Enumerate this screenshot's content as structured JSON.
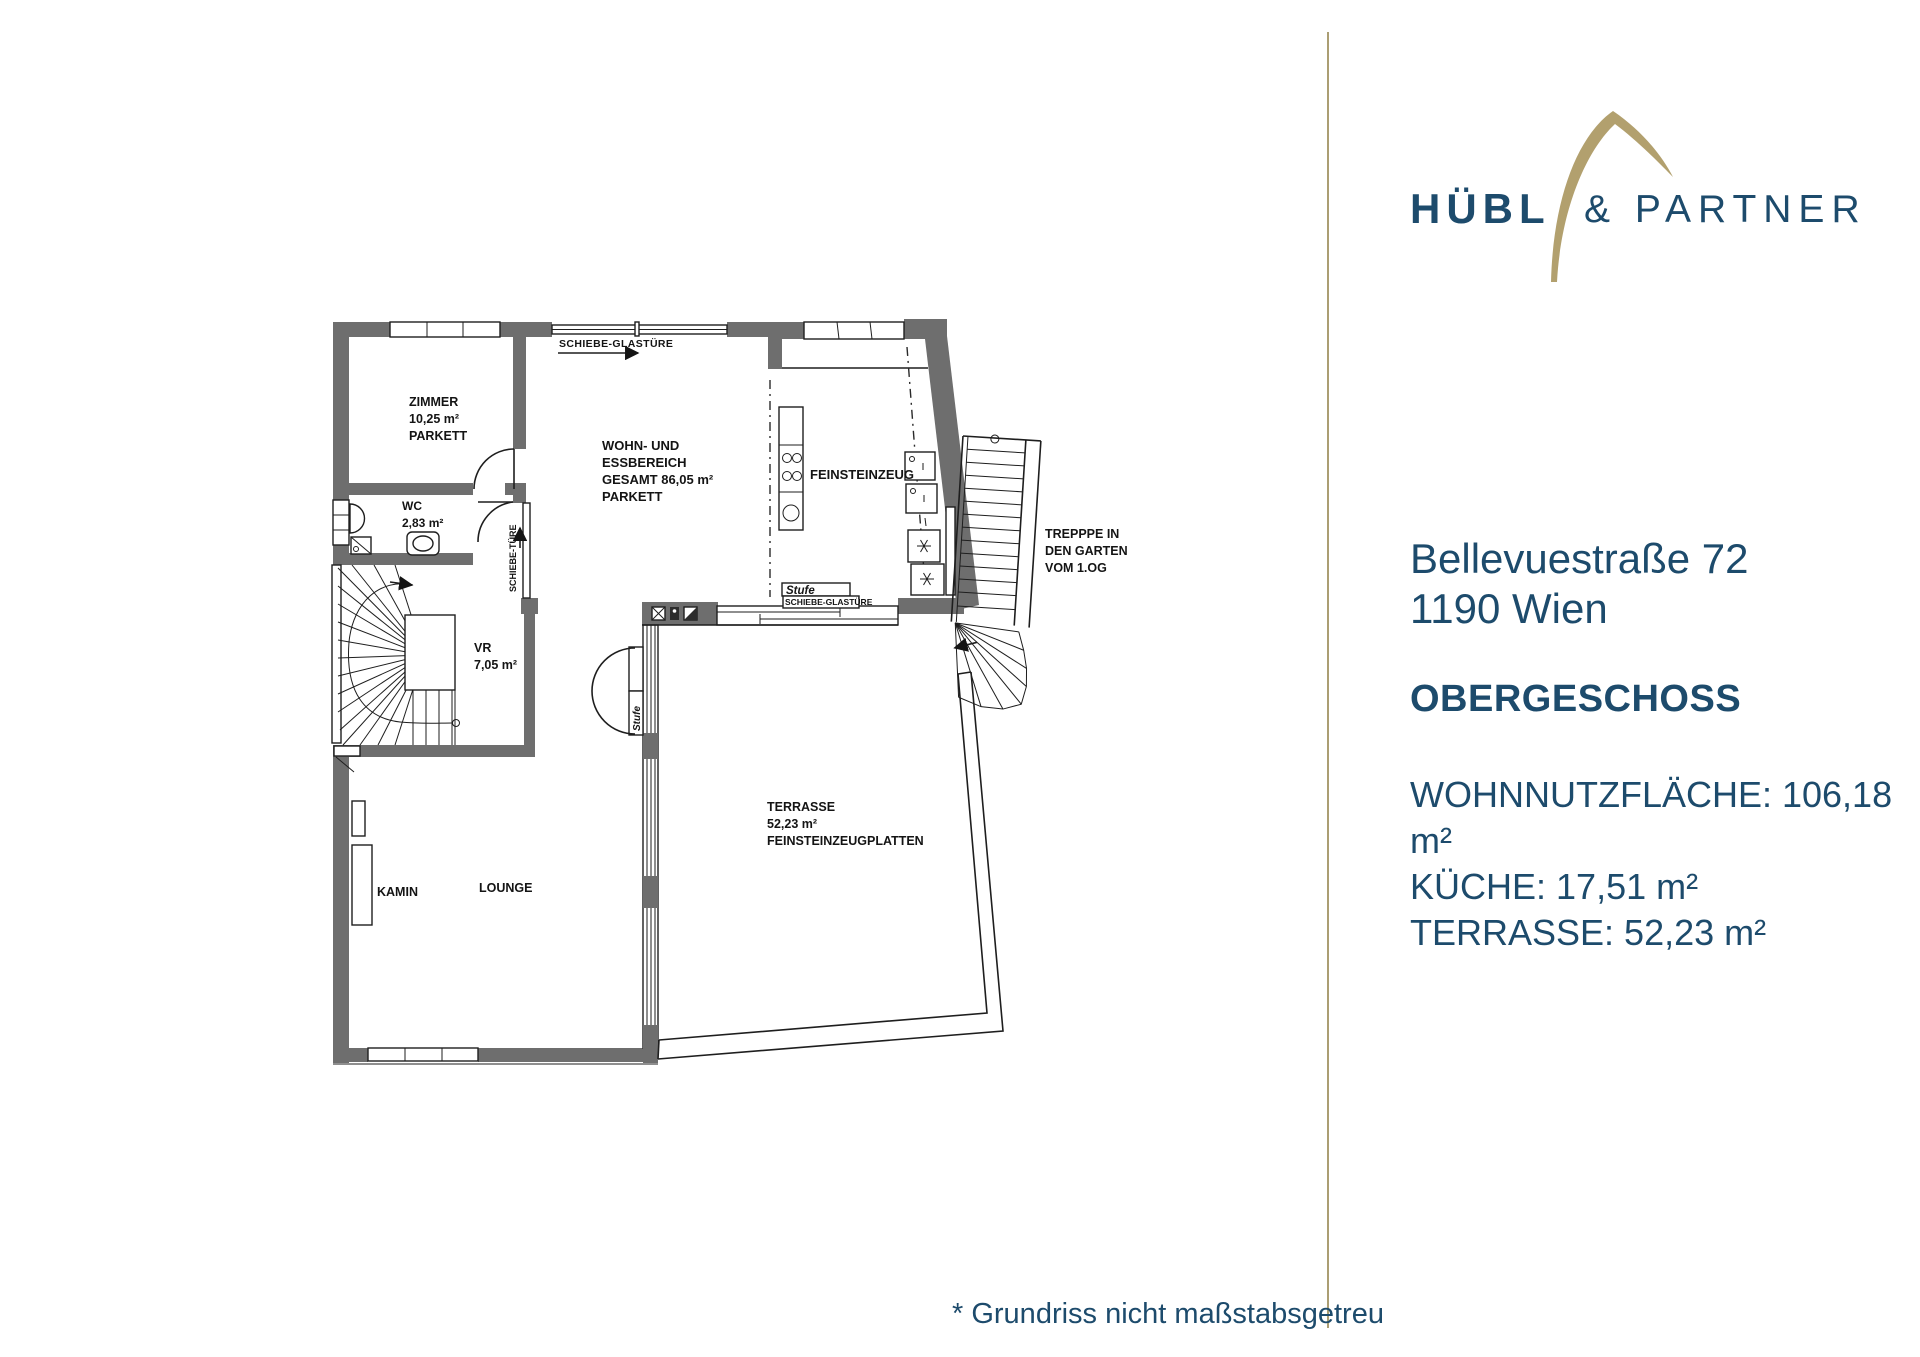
{
  "brand": {
    "word_primary": "HÜBL",
    "word_secondary": "& PARTNER"
  },
  "colors": {
    "navy": "#1d4b6c",
    "gold": "#b2a06e",
    "wall_gray": "#6e6e6e"
  },
  "panel": {
    "address_line1": "Bellevuestraße 72",
    "address_line2": "1190 Wien",
    "floor_title": "OBERGESCHOSS",
    "area_lines": [
      "WOHNNUTZFLÄCHE: 106,18 m²",
      "KÜCHE: 17,51 m²",
      "TERRASSE: 52,23 m²"
    ]
  },
  "footnote": "* Grundriss nicht maßstabsgetreu",
  "plan": {
    "schiebe_glastuere": "SCHIEBE-GLASTÜRE",
    "zimmer": [
      "ZIMMER",
      "10,25 m²",
      "PARKETT"
    ],
    "wohn": [
      "WOHN- UND",
      "ESSBEREICH",
      "GESAMT 86,05 m²",
      "PARKETT"
    ],
    "wc": [
      "WC",
      "2,83 m²"
    ],
    "schiebe_tuere": "SCHIEBE-TÜRE",
    "vr": [
      "VR",
      "7,05 m²"
    ],
    "feinsteinzeug": "FEINSTEINZEUG",
    "treppe": [
      "TREPPPE IN",
      "DEN GARTEN",
      "VOM 1.OG"
    ],
    "stufe": "Stufe",
    "kamin": "KAMIN",
    "lounge": "LOUNGE",
    "terrasse": [
      "TERRASSE",
      "52,23 m²",
      "FEINSTEINZEUGPLATTEN"
    ]
  }
}
